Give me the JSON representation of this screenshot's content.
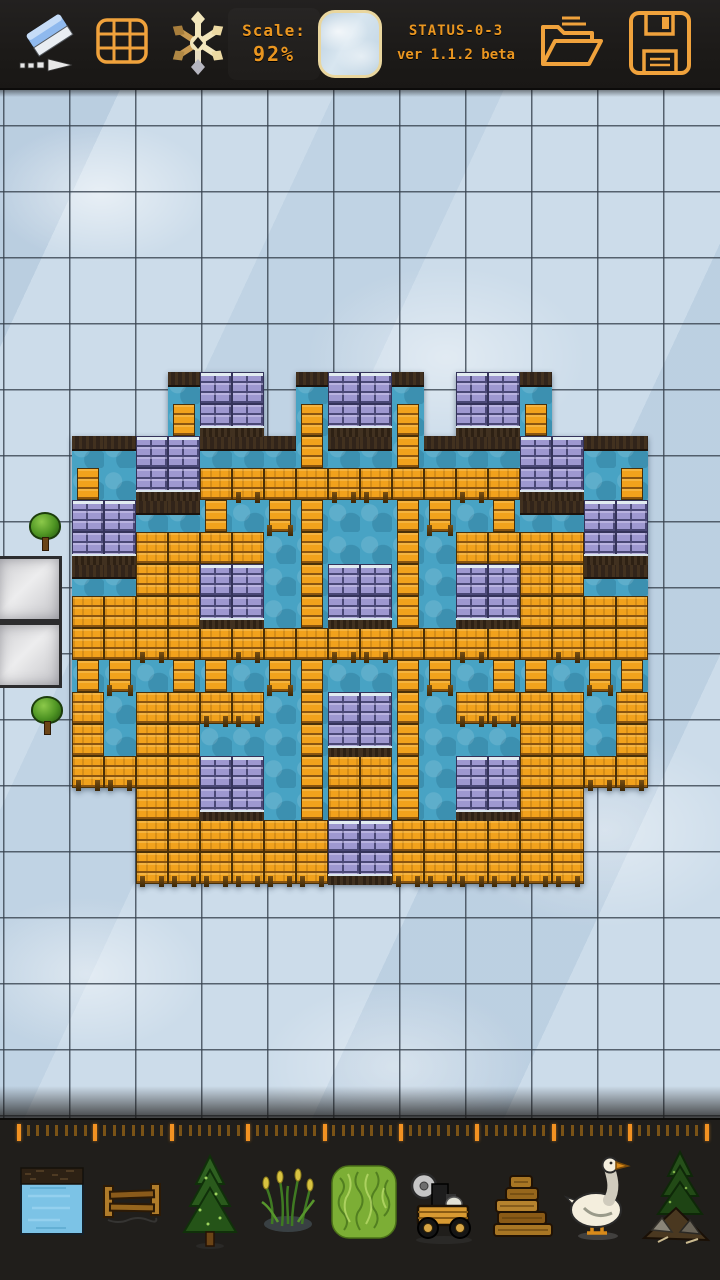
{
  "app": {
    "name": "tile map editor",
    "accent_color": "#f0a23c",
    "text_color": "#ea9620"
  },
  "toolbar": {
    "scale_label": "Scale:",
    "scale_value": "92%",
    "status_line1": "STATUS-0-3",
    "status_line2": "ver 1.1.2 beta",
    "buttons": [
      "eraser",
      "grid-toggle",
      "snowflake-tool",
      "scale-indicator",
      "tile-preview",
      "status-info",
      "open-file",
      "save-file"
    ]
  },
  "map": {
    "scale_percent": 92,
    "grid": {
      "cell_size": 66,
      "offset_x": 3,
      "offset_y": 35,
      "line_color": "#37424e"
    },
    "colors": {
      "ice": "#ccdcea",
      "water": "#48a3c4",
      "plank": "#f2a21c",
      "brick": "#9e98d0",
      "brick_mortar": "#4a4876",
      "dirt": "#31241a",
      "snow": "#e2ecf1",
      "stone": "#d6d6d8",
      "tree_foliage": "#4e9423"
    },
    "structure": {
      "origin": [
        72,
        372
      ],
      "tile": 32,
      "legend": {
        ".": "empty-ice",
        "w": "water",
        "d": "water-with-dirt-top",
        "P": "plank-deck",
        "B": "stone-brick",
        "T": "plank-post-on-water"
      },
      "rows": [
        "...dBB.dBBd.BBd...",
        "...TBB.TBBT.BBT...",
        "ddBBdddTddTdddBBdd",
        "TwBBPPPPPPPPPPBBwT",
        "BBddTwTTwwTTwTddBB",
        "BBPPPPwTwwTwPPPPBB",
        "ddPPBBwTBBTwBBPPdd",
        "PPPPBBwTBBTwBBPPPP",
        "PPPPPPPPPPPPPPPPPP",
        "TTwTTwTTwwTTwTTwTT",
        "PwPPPPwTBBTwPPPPwP",
        "PwPPwwwTBBTwwwPPwP",
        "PPPPBBwTPPTwBBPPPP",
        "..PPBBwTPPTwBBPP..",
        "..PPPPPPBBPPPPPP..",
        "..PPPPPPBBPPPPPP.."
      ]
    },
    "environment": [
      {
        "type": "tree",
        "x": 25,
        "y": 512
      },
      {
        "type": "tree",
        "x": 27,
        "y": 696
      },
      {
        "type": "stone",
        "x": -4,
        "y": 556
      },
      {
        "type": "stone",
        "x": -4,
        "y": 622
      }
    ]
  },
  "ruler": {
    "start_x": 17,
    "spacing": 9.55,
    "tick_count": 73,
    "major_every": 8,
    "minor_color": "#7a5316",
    "major_color": "#f29222"
  },
  "palette": {
    "items": [
      {
        "name": "water-tile",
        "icon": "water",
        "x": 16,
        "y": 1144
      },
      {
        "name": "fence",
        "icon": "fence",
        "x": 96,
        "y": 1146
      },
      {
        "name": "pine-tree",
        "icon": "pine",
        "x": 174,
        "y": 1152
      },
      {
        "name": "reeds",
        "icon": "reeds",
        "x": 252,
        "y": 1146
      },
      {
        "name": "grass-tile",
        "icon": "grass",
        "x": 328,
        "y": 1146
      },
      {
        "name": "saw-cart",
        "icon": "cart",
        "x": 406,
        "y": 1152
      },
      {
        "name": "wood-pile",
        "icon": "wood",
        "x": 488,
        "y": 1152
      },
      {
        "name": "goose",
        "icon": "goose",
        "x": 564,
        "y": 1148
      },
      {
        "name": "tree-with-rocks",
        "icon": "tree2",
        "x": 640,
        "y": 1148
      }
    ]
  }
}
